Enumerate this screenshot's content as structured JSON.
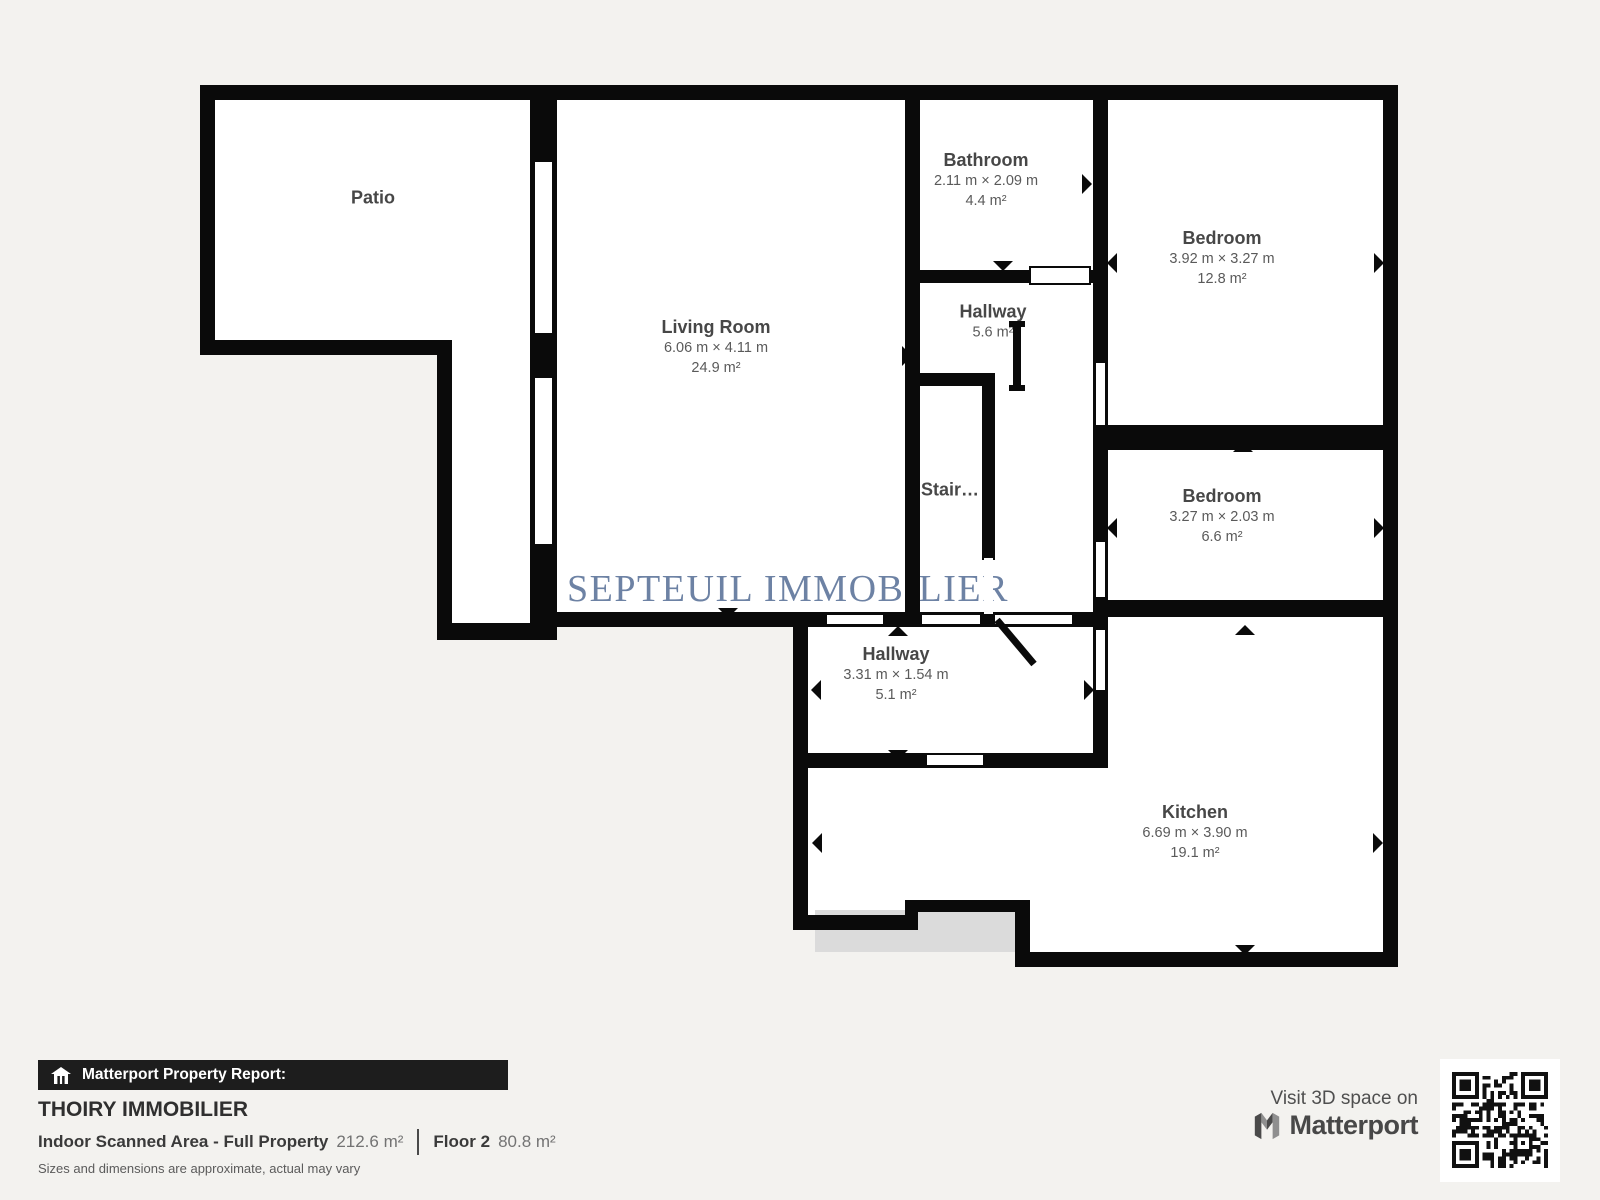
{
  "floor_plan": {
    "watermark": "SEPTEUIL IMMOBILIER",
    "rooms": [
      {
        "name": "Patio",
        "dims": "",
        "area": ""
      },
      {
        "name": "Living Room",
        "dims": "6.06 m × 4.11 m",
        "area": "24.9 m²"
      },
      {
        "name": "Bathroom",
        "dims": "2.11 m × 2.09 m",
        "area": "4.4 m²"
      },
      {
        "name": "Hallway",
        "dims": "",
        "area": "5.6 m²"
      },
      {
        "name": "Bedroom",
        "dims": "3.92 m × 3.27 m",
        "area": "12.8 m²"
      },
      {
        "name": "Bedroom",
        "dims": "3.27 m × 2.03 m",
        "area": "6.6 m²"
      },
      {
        "name": "Stair…",
        "dims": "",
        "area": ""
      },
      {
        "name": "Hallway",
        "dims": "3.31 m × 1.54 m",
        "area": "5.1 m²"
      },
      {
        "name": "Kitchen",
        "dims": "6.69 m × 3.90 m",
        "area": "19.1 m²"
      }
    ]
  },
  "report": {
    "bar_label": "Matterport Property Report:",
    "property_name": "THOIRY IMMOBILIER",
    "scanned_area_label": "Indoor Scanned Area - Full Property",
    "scanned_area_value": "212.6 m²",
    "floor_label": "Floor 2",
    "floor_value": "80.8 m²",
    "disclaimer": "Sizes and dimensions are approximate, actual may vary"
  },
  "footer": {
    "visit_text": "Visit 3D space on",
    "brand": "Matterport"
  },
  "icons": [
    "house-icon",
    "matterport-m-logo",
    "qr-code"
  ],
  "colors": {
    "wall": "#000000",
    "background": "#f3f2ef",
    "floor": "#ffffff",
    "watermark": "#6d82a4",
    "report_bar": "#1d1d1d",
    "floor_below_shadow": "#dbdbdb"
  }
}
